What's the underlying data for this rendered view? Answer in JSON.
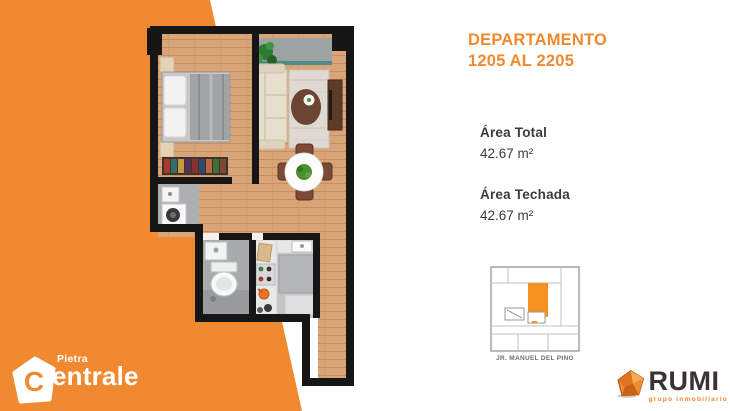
{
  "palette": {
    "orange": "#F0892F",
    "dark_text": "#3B3B3B",
    "wall": "#161616",
    "keyplan_highlight": "#F59120"
  },
  "heading": {
    "line1": "DEPARTAMENTO",
    "line2": "1205 AL 2205"
  },
  "specs": [
    {
      "label": "Área Total",
      "value": "42.67 m²"
    },
    {
      "label": "Área Techada",
      "value": "42.67 m²"
    }
  ],
  "keyplan": {
    "street": "JR. MANUEL DEL PINO"
  },
  "logos": {
    "pietra": {
      "word_top": "Pietra",
      "monogram": "C",
      "word_rest": "entrale"
    },
    "rumi": {
      "name": "RUMI",
      "tagline": "grupo inmobiliario"
    }
  }
}
